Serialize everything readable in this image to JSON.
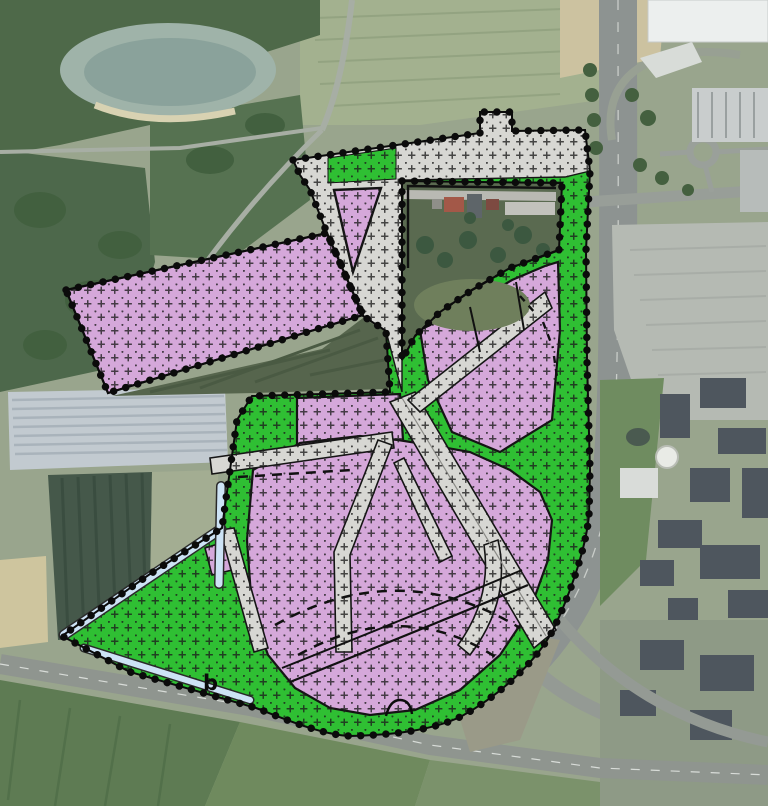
{
  "map": {
    "kind": "zoning-plan-overlay-on-aerial-photo",
    "annotations": {
      "building_code": "b"
    },
    "colors": {
      "zone_traffic_gray": "#d7d7d3",
      "zone_green": "#2fbf33",
      "zone_business_purple": "#d5a8da",
      "zone_water_blue": "#cde3f5",
      "plan_boundary_black": "#0b0b0b",
      "hatch_cross_black": "#1c1c1c",
      "aerial_field_olive": "#99a58d",
      "aerial_forest_green": "#4e6949",
      "aerial_road_gray": "#979d97",
      "aerial_building_slate": "#4e565e",
      "aerial_building_white": "#ecefee",
      "excluded_parcel_field": "#5a6a50"
    }
  }
}
